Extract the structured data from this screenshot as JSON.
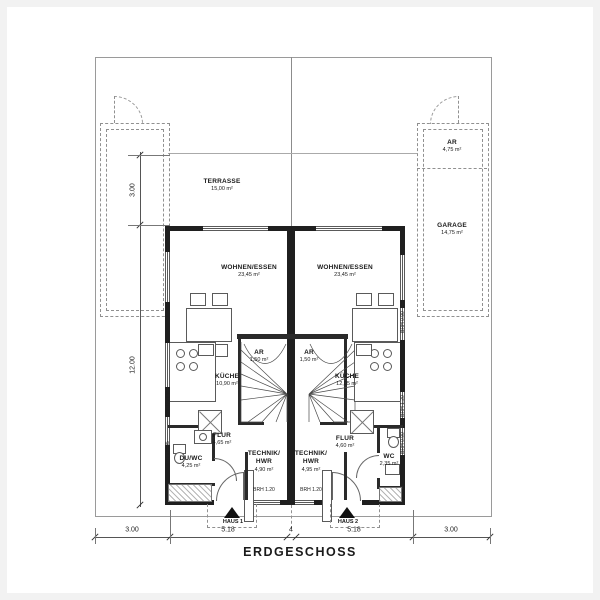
{
  "title": "ERDGESCHOSS",
  "rooms": {
    "terrasse": {
      "name": "TERRASSE",
      "area": "15,00 m²"
    },
    "wohnen1": {
      "name": "WOHNEN/ESSEN",
      "area": "23,45 m²"
    },
    "wohnen2": {
      "name": "WOHNEN/ESSEN",
      "area": "23,45 m²"
    },
    "kueche1": {
      "name": "KÜCHE",
      "area": "10,90 m²"
    },
    "kueche2": {
      "name": "KÜCHE",
      "area": "12,05 m²"
    },
    "ar1": {
      "name": "AR",
      "area": "1,50 m²"
    },
    "ar2": {
      "name": "AR",
      "area": "1,50 m²"
    },
    "flur1": {
      "name": "FLUR",
      "area": "4,65 m²"
    },
    "flur2": {
      "name": "FLUR",
      "area": "4,60 m²"
    },
    "technik1": {
      "name": "TECHNIK/",
      "name2": "HWR",
      "area": "4,90 m²"
    },
    "technik2": {
      "name": "TECHNIK/",
      "name2": "HWR",
      "area": "4,95 m²"
    },
    "duwc": {
      "name": "DU/WC",
      "area": "4,25 m²"
    },
    "wc": {
      "name": "WC",
      "area": "2,35 m²"
    },
    "garage": {
      "name": "GARAGE",
      "area": "14,75 m²"
    },
    "ar_garage": {
      "name": "AR",
      "area": "4,75 m²"
    }
  },
  "sills": {
    "left_kueche": "BRH 1.35",
    "left_duwc": "BRH 1.35",
    "right_essen": "BRH 0.90",
    "right_kueche": "BRH 1.20",
    "right_wc": "BRH 0.90",
    "technik1": "BRH 1.20",
    "technik2": "BRH 1.20"
  },
  "houses": {
    "h1": "HAUS 1",
    "h2": "HAUS 2"
  },
  "dimensions": {
    "bottom": [
      "3.00",
      "5.18",
      "4",
      "5.18",
      "3.00"
    ],
    "left": [
      "3.00",
      "12.00"
    ]
  },
  "line_color": "#1f1f1f",
  "dash_color": "#909090"
}
